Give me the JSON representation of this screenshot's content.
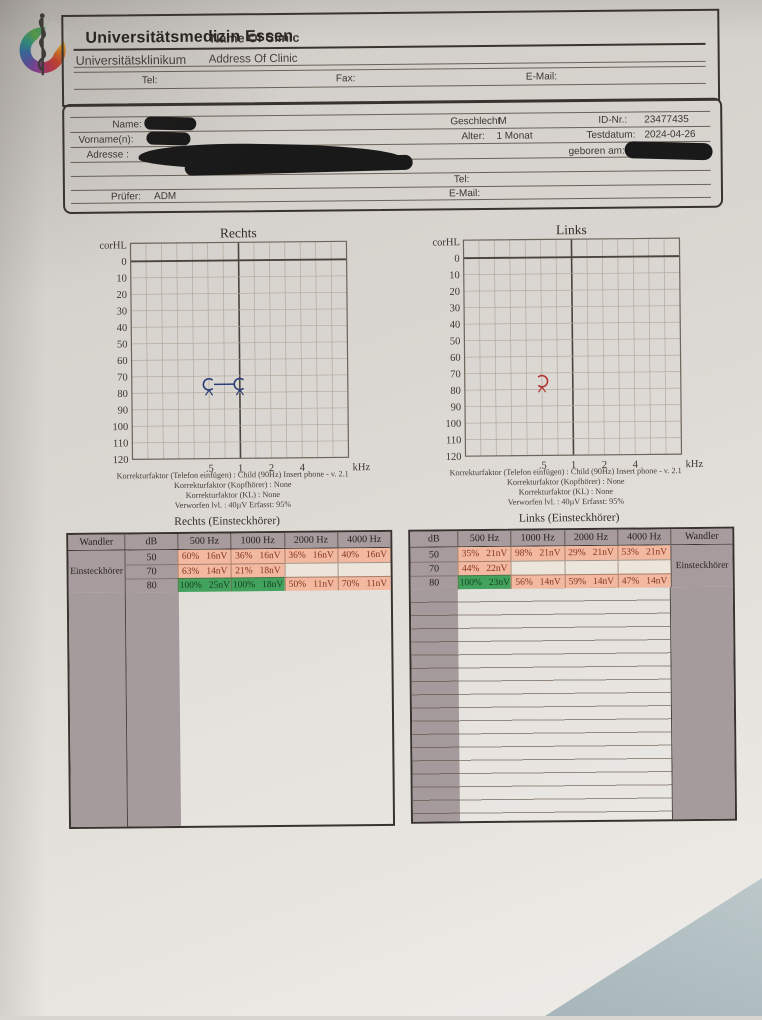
{
  "header": {
    "org_title": "Universitätsmedizin Essen",
    "org_title_overlay": "Name Of Clinic",
    "org_subtitle": "Universitätsklinikum",
    "org_subtitle_overlay": "Address Of Clinic",
    "tel_label": "Tel:",
    "fax_label": "Fax:",
    "email_label": "E-Mail:"
  },
  "patient": {
    "name_label": "Name:",
    "vorname_label": "Vorname(n):",
    "adresse_label": "Adresse :",
    "geschlecht_label": "Geschlecht",
    "geschlecht_value": "M",
    "alter_label": "Alter:",
    "alter_value": "1 Monat",
    "id_label": "ID-Nr.:",
    "id_value": "23477435",
    "testdatum_label": "Testdatum:",
    "testdatum_value": "2024-04-26",
    "geboren_label": "geboren am:",
    "tel_label": "Tel:",
    "email_label": "E-Mail:",
    "pruefer_label": "Prüfer:",
    "pruefer_value": "ADM"
  },
  "chart_data": [
    {
      "type": "scatter",
      "id": "chart-rechts",
      "title": "Rechts",
      "ylabel": "corHL",
      "ylim": [
        0,
        120
      ],
      "yticks": [
        0,
        10,
        20,
        30,
        40,
        50,
        60,
        70,
        80,
        90,
        100,
        110,
        120
      ],
      "xticks": [
        ".5",
        "1",
        "2",
        "4"
      ],
      "xunit": "kHz",
      "grid": true,
      "series": [
        {
          "name": "rechts-threshold",
          "color": "#2c3e78",
          "symbol": "arc-right",
          "no_response_arrow": true,
          "connected": true,
          "points": [
            {
              "f": 0.5,
              "db": 75
            },
            {
              "f": 1,
              "db": 75
            }
          ]
        }
      ]
    },
    {
      "type": "scatter",
      "id": "chart-links",
      "title": "Links",
      "ylabel": "corHL",
      "ylim": [
        0,
        120
      ],
      "yticks": [
        0,
        10,
        20,
        30,
        40,
        50,
        60,
        70,
        80,
        90,
        100,
        110,
        120
      ],
      "xticks": [
        ".5",
        "1",
        "2",
        "4"
      ],
      "xunit": "kHz",
      "grid": true,
      "series": [
        {
          "name": "links-threshold",
          "color": "#b23432",
          "symbol": "arc-left",
          "no_response_arrow": true,
          "connected": false,
          "points": [
            {
              "f": 0.5,
              "db": 75
            }
          ]
        }
      ]
    }
  ],
  "footnotes": {
    "rechts": [
      "Korrekturfaktor (Telefon einfügen) : Child (90Hz) Insert phone - v. 2.1",
      "Korrekturfaktor (Kopfhörer) : None",
      "Korrekturfaktor (KL) : None",
      "Verworfen lvl. : 40µV Erfasst: 95%"
    ],
    "links": [
      "Korrekturfaktor (Telefon einfügen) : Child (90Hz) Insert phone - v. 2.1",
      "Korrekturfaktor (Kopfhörer) : None",
      "Korrekturfaktor (KL) : None",
      "Verworfen lvl. : 40µV Erfasst: 95%"
    ]
  },
  "tables": {
    "colors": {
      "header_bg": "#a79b9e",
      "pink": "#f2b8a0",
      "green": "#43a35e",
      "pink_text": "#84351f",
      "green_text": "#14401d"
    },
    "rechts": {
      "title": "Rechts (Einsteckhörer)",
      "wandler_header": "Wandler",
      "wandler_value": "Einsteckhörer",
      "db_header": "dB",
      "freq_headers": [
        "500 Hz",
        "1000 Hz",
        "2000 Hz",
        "4000 Hz"
      ],
      "wandler_side": "left",
      "rows": [
        {
          "db": "50",
          "cells": [
            {
              "pct": "60%",
              "nv": "16nV",
              "tone": "pink"
            },
            {
              "pct": "36%",
              "nv": "16nV",
              "tone": "pink"
            },
            {
              "pct": "36%",
              "nv": "16nV",
              "tone": "pink"
            },
            {
              "pct": "40%",
              "nv": "16nV",
              "tone": "pink"
            }
          ]
        },
        {
          "db": "70",
          "cells": [
            {
              "pct": "63%",
              "nv": "14nV",
              "tone": "pink"
            },
            {
              "pct": "21%",
              "nv": "18nV",
              "tone": "pink"
            },
            {
              "tone": "empty"
            },
            {
              "tone": "empty"
            }
          ]
        },
        {
          "db": "80",
          "cells": [
            {
              "pct": "100%",
              "nv": "25nV",
              "tone": "green"
            },
            {
              "pct": "100%",
              "nv": "18nV",
              "tone": "green"
            },
            {
              "pct": "50%",
              "nv": "11nV",
              "tone": "pink"
            },
            {
              "pct": "70%",
              "nv": "11nV",
              "tone": "pink"
            }
          ]
        }
      ]
    },
    "links": {
      "title": "Links (Einsteckhörer)",
      "wandler_header": "Wandler",
      "wandler_value": "Einsteckhörer",
      "db_header": "dB",
      "freq_headers": [
        "500 Hz",
        "1000 Hz",
        "2000 Hz",
        "4000 Hz"
      ],
      "wandler_side": "right",
      "rows": [
        {
          "db": "50",
          "cells": [
            {
              "pct": "35%",
              "nv": "21nV",
              "tone": "pink"
            },
            {
              "pct": "98%",
              "nv": "21nV",
              "tone": "pink"
            },
            {
              "pct": "29%",
              "nv": "21nV",
              "tone": "pink"
            },
            {
              "pct": "53%",
              "nv": "21nV",
              "tone": "pink"
            }
          ]
        },
        {
          "db": "70",
          "cells": [
            {
              "pct": "44%",
              "nv": "22nV",
              "tone": "pink"
            },
            {
              "tone": "empty"
            },
            {
              "tone": "empty"
            },
            {
              "tone": "empty"
            }
          ]
        },
        {
          "db": "80",
          "cells": [
            {
              "pct": "100%",
              "nv": "23nV",
              "tone": "green"
            },
            {
              "pct": "56%",
              "nv": "14nV",
              "tone": "pink"
            },
            {
              "pct": "59%",
              "nv": "14nV",
              "tone": "pink"
            },
            {
              "pct": "47%",
              "nv": "14nV",
              "tone": "pink"
            }
          ]
        }
      ]
    }
  }
}
